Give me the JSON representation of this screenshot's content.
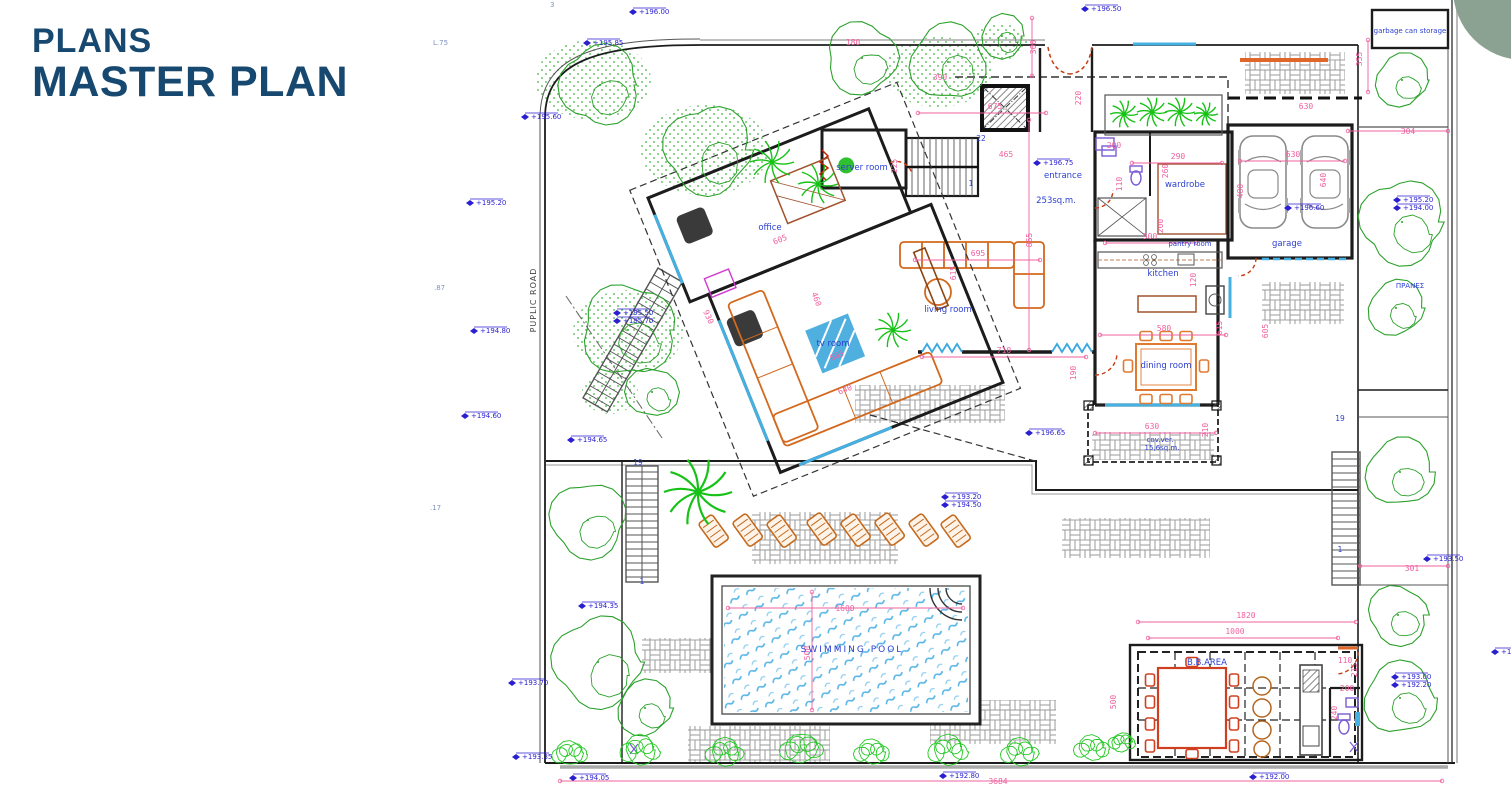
{
  "header": {
    "line1": "PLANS",
    "line2": "MASTER PLAN"
  },
  "colors": {
    "title": "#17486f",
    "accent_circle": "#8ba292",
    "dimension": "#f0609f",
    "elevation": "#2a1fd0",
    "room_label": "#2b3fd0",
    "tree": "#2ca12c",
    "palm": "#16c216",
    "furniture": "#d2691e",
    "pool_water": "#58b5e6",
    "wall": "#1c1c1c"
  },
  "plan": {
    "road_label": {
      "t": "PUPLIC ROAD",
      "x": 536,
      "y": 300
    },
    "labels": [
      {
        "t": "server room",
        "x": 862,
        "y": 170,
        "cls": "room"
      },
      {
        "t": "entrance",
        "x": 1063,
        "y": 178,
        "cls": "room"
      },
      {
        "t": "253sq.m.",
        "x": 1056,
        "y": 203,
        "cls": "room"
      },
      {
        "t": "wardrobe",
        "x": 1185,
        "y": 187,
        "cls": "room"
      },
      {
        "t": "office",
        "x": 770,
        "y": 230,
        "cls": "room"
      },
      {
        "t": "tv room",
        "x": 833,
        "y": 346,
        "cls": "room"
      },
      {
        "t": "living room",
        "x": 948,
        "y": 312,
        "cls": "room"
      },
      {
        "t": "kitchen",
        "x": 1163,
        "y": 276,
        "cls": "room"
      },
      {
        "t": "pantry room",
        "x": 1190,
        "y": 246,
        "cls": "small"
      },
      {
        "t": "dining room",
        "x": 1166,
        "y": 368,
        "cls": "room"
      },
      {
        "t": "garage",
        "x": 1287,
        "y": 246,
        "cls": "room"
      },
      {
        "t": "garbage can storage",
        "x": 1410,
        "y": 33,
        "cls": "small"
      },
      {
        "t": "ΠΡΑΝΕΣ",
        "x": 1410,
        "y": 288,
        "cls": "small"
      },
      {
        "t": "SWIMMING POOL",
        "x": 852,
        "y": 652,
        "cls": "pool"
      },
      {
        "t": "B.B.AREA",
        "x": 1207,
        "y": 665,
        "cls": "room"
      },
      {
        "t": "cov.ver.",
        "x": 1160,
        "y": 442,
        "cls": "small"
      },
      {
        "t": "15,6sq.m.",
        "x": 1162,
        "y": 450,
        "cls": "small"
      },
      {
        "t": "22",
        "x": 981,
        "y": 141,
        "cls": "num"
      },
      {
        "t": "1",
        "x": 971,
        "y": 186,
        "cls": "num"
      },
      {
        "t": "19",
        "x": 638,
        "y": 465,
        "cls": "num"
      },
      {
        "t": "1",
        "x": 642,
        "y": 584,
        "cls": "num"
      },
      {
        "t": "19",
        "x": 1340,
        "y": 421,
        "cls": "num"
      },
      {
        "t": "1",
        "x": 1340,
        "y": 552,
        "cls": "num"
      },
      {
        "t": "L.75",
        "x": 433,
        "y": 45,
        "cls": "note"
      },
      {
        "t": ".87",
        "x": 434,
        "y": 290,
        "cls": "note"
      },
      {
        "t": ".17",
        "x": 430,
        "y": 510,
        "cls": "note"
      },
      {
        "t": "3",
        "x": 550,
        "y": 7,
        "cls": "note"
      }
    ],
    "dimensions": [
      {
        "t": "675",
        "x": 995,
        "y": 109
      },
      {
        "t": "180",
        "x": 853,
        "y": 45
      },
      {
        "t": "390",
        "x": 940,
        "y": 80
      },
      {
        "t": "225",
        "x": 897,
        "y": 166,
        "rot": -90
      },
      {
        "t": "465",
        "x": 1006,
        "y": 157
      },
      {
        "t": "300",
        "x": 1036,
        "y": 47,
        "rot": -90
      },
      {
        "t": "220",
        "x": 1081,
        "y": 98,
        "rot": -90
      },
      {
        "t": "865",
        "x": 1032,
        "y": 240,
        "rot": -90
      },
      {
        "t": "695",
        "x": 978,
        "y": 256
      },
      {
        "t": "615",
        "x": 956,
        "y": 273,
        "rot": -90
      },
      {
        "t": "605",
        "x": 781,
        "y": 242,
        "rot": -22
      },
      {
        "t": "930",
        "x": 706,
        "y": 318,
        "rot": 66
      },
      {
        "t": "605",
        "x": 838,
        "y": 358,
        "rot": -22
      },
      {
        "t": "640",
        "x": 846,
        "y": 392,
        "rot": -22
      },
      {
        "t": "460",
        "x": 814,
        "y": 300,
        "rot": 70
      },
      {
        "t": "710",
        "x": 1004,
        "y": 353
      },
      {
        "t": "190",
        "x": 1076,
        "y": 373,
        "rot": -90
      },
      {
        "t": "290",
        "x": 1178,
        "y": 159
      },
      {
        "t": "110",
        "x": 1122,
        "y": 184,
        "rot": -90
      },
      {
        "t": "260",
        "x": 1168,
        "y": 171,
        "rot": -90
      },
      {
        "t": "200",
        "x": 1163,
        "y": 226,
        "rot": -90
      },
      {
        "t": "200",
        "x": 1114,
        "y": 148
      },
      {
        "t": "500",
        "x": 1150,
        "y": 239
      },
      {
        "t": "580",
        "x": 1164,
        "y": 331
      },
      {
        "t": "120",
        "x": 1196,
        "y": 280,
        "rot": -90
      },
      {
        "t": "615",
        "x": 1222,
        "y": 328,
        "rot": -90
      },
      {
        "t": "605",
        "x": 1268,
        "y": 331,
        "rot": -90
      },
      {
        "t": "480",
        "x": 1243,
        "y": 191,
        "rot": -90
      },
      {
        "t": "630",
        "x": 1293,
        "y": 157
      },
      {
        "t": "640",
        "x": 1326,
        "y": 180,
        "rot": -90
      },
      {
        "t": "355",
        "x": 1362,
        "y": 59,
        "rot": -90
      },
      {
        "t": "630",
        "x": 1306,
        "y": 109
      },
      {
        "t": "304",
        "x": 1408,
        "y": 134
      },
      {
        "t": "301",
        "x": 1412,
        "y": 571
      },
      {
        "t": "1600",
        "x": 845,
        "y": 611
      },
      {
        "t": "500",
        "x": 810,
        "y": 653,
        "rot": -90
      },
      {
        "t": "1820",
        "x": 1246,
        "y": 618
      },
      {
        "t": "1000",
        "x": 1235,
        "y": 634
      },
      {
        "t": "110",
        "x": 1345,
        "y": 663
      },
      {
        "t": "215",
        "x": 1357,
        "y": 670,
        "rot": -90
      },
      {
        "t": "200",
        "x": 1347,
        "y": 691
      },
      {
        "t": "240",
        "x": 1337,
        "y": 713,
        "rot": -90
      },
      {
        "t": "500",
        "x": 1116,
        "y": 702,
        "rot": -90
      },
      {
        "t": "3684",
        "x": 998,
        "y": 784
      },
      {
        "t": "630",
        "x": 1152,
        "y": 429
      },
      {
        "t": "210",
        "x": 1208,
        "y": 430,
        "rot": -90
      }
    ],
    "elevations": [
      {
        "t": "+196.00",
        "x": 640,
        "y": 12
      },
      {
        "t": "+195.85",
        "x": 594,
        "y": 43
      },
      {
        "t": "+195.60",
        "x": 532,
        "y": 117
      },
      {
        "t": "+196.50",
        "x": 1092,
        "y": 9
      },
      {
        "t": "+195.20",
        "x": 477,
        "y": 203
      },
      {
        "t": "+194.80",
        "x": 481,
        "y": 331
      },
      {
        "t": "+194.60",
        "x": 472,
        "y": 416
      },
      {
        "t": "+194.65",
        "x": 578,
        "y": 440
      },
      {
        "t": "+194.35",
        "x": 589,
        "y": 606
      },
      {
        "t": "+193.70",
        "x": 519,
        "y": 683
      },
      {
        "t": "+193.35",
        "x": 523,
        "y": 757
      },
      {
        "t": "+194.05",
        "x": 580,
        "y": 778
      },
      {
        "t": "+192.80",
        "x": 950,
        "y": 776
      },
      {
        "t": "+192.00",
        "x": 1260,
        "y": 777
      },
      {
        "t": "+196.75",
        "x": 1044,
        "y": 163
      },
      {
        "t": "+196.65",
        "x": 1036,
        "y": 433
      },
      {
        "t": "+193.20",
        "x": 952,
        "y": 497
      },
      {
        "t": "+194.50",
        "x": 952,
        "y": 505
      },
      {
        "t": "+195.50",
        "x": 624,
        "y": 313
      },
      {
        "t": "+195.70",
        "x": 624,
        "y": 321
      },
      {
        "t": "+195.20",
        "x": 1404,
        "y": 200
      },
      {
        "t": "+194.00",
        "x": 1404,
        "y": 208
      },
      {
        "t": "+196.60",
        "x": 1295,
        "y": 208
      },
      {
        "t": "+193.50",
        "x": 1434,
        "y": 559
      },
      {
        "t": "+193.00",
        "x": 1402,
        "y": 677
      },
      {
        "t": "+192.20",
        "x": 1402,
        "y": 685
      },
      {
        "t": "+19",
        "x": 1502,
        "y": 652
      }
    ],
    "dim_lines": [
      [
        728,
        608,
        963,
        608
      ],
      [
        812,
        592,
        812,
        710
      ],
      [
        1138,
        622,
        1356,
        622
      ],
      [
        1148,
        638,
        1338,
        638
      ],
      [
        918,
        113,
        1046,
        113
      ],
      [
        922,
        357,
        1086,
        357
      ],
      [
        1132,
        163,
        1222,
        163
      ],
      [
        1240,
        161,
        1345,
        161
      ],
      [
        1100,
        335,
        1226,
        335
      ],
      [
        1105,
        243,
        1196,
        243
      ],
      [
        915,
        260,
        1040,
        260
      ],
      [
        1095,
        433,
        1216,
        433
      ],
      [
        1348,
        131,
        1448,
        131
      ],
      [
        1360,
        566,
        1448,
        566
      ],
      [
        1032,
        18,
        1032,
        76
      ],
      [
        1368,
        40,
        1368,
        92
      ],
      [
        560,
        781,
        1442,
        781
      ],
      [
        1029,
        120,
        1029,
        350
      ]
    ],
    "trees": [
      {
        "x": 600,
        "y": 85,
        "r": 40
      },
      {
        "x": 708,
        "y": 150,
        "r": 44
      },
      {
        "x": 862,
        "y": 58,
        "r": 36
      },
      {
        "x": 948,
        "y": 62,
        "r": 38
      },
      {
        "x": 1002,
        "y": 36,
        "r": 22
      },
      {
        "x": 628,
        "y": 330,
        "r": 46
      },
      {
        "x": 652,
        "y": 392,
        "r": 26
      },
      {
        "x": 588,
        "y": 520,
        "r": 38
      },
      {
        "x": 598,
        "y": 662,
        "r": 45
      },
      {
        "x": 645,
        "y": 708,
        "r": 28
      },
      {
        "x": 1402,
        "y": 80,
        "r": 27
      },
      {
        "x": 1402,
        "y": 222,
        "r": 42
      },
      {
        "x": 1396,
        "y": 308,
        "r": 28
      },
      {
        "x": 1400,
        "y": 472,
        "r": 34
      },
      {
        "x": 1398,
        "y": 615,
        "r": 30
      },
      {
        "x": 1400,
        "y": 698,
        "r": 36
      }
    ],
    "palms": [
      {
        "x": 698,
        "y": 492,
        "r": 34
      },
      {
        "x": 772,
        "y": 162,
        "r": 22
      },
      {
        "x": 818,
        "y": 184,
        "r": 20
      },
      {
        "x": 893,
        "y": 330,
        "r": 18
      },
      {
        "x": 1124,
        "y": 114,
        "r": 14
      },
      {
        "x": 1152,
        "y": 112,
        "r": 15
      },
      {
        "x": 1180,
        "y": 112,
        "r": 15
      },
      {
        "x": 1206,
        "y": 114,
        "r": 12
      }
    ],
    "hedges": [
      {
        "x": 593,
        "y": 80,
        "rx": 58,
        "ry": 40
      },
      {
        "x": 705,
        "y": 150,
        "rx": 64,
        "ry": 45
      },
      {
        "x": 938,
        "y": 72,
        "rx": 55,
        "ry": 35
      },
      {
        "x": 628,
        "y": 332,
        "rx": 55,
        "ry": 42
      },
      {
        "x": 610,
        "y": 392,
        "rx": 28,
        "ry": 22
      },
      {
        "x": 1000,
        "y": 42,
        "rx": 28,
        "ry": 18
      }
    ],
    "shrubs": [
      {
        "x": 570,
        "y": 753,
        "r": 13
      },
      {
        "x": 640,
        "y": 750,
        "r": 15
      },
      {
        "x": 725,
        "y": 752,
        "r": 14
      },
      {
        "x": 802,
        "y": 748,
        "r": 16
      },
      {
        "x": 872,
        "y": 752,
        "r": 13
      },
      {
        "x": 948,
        "y": 750,
        "r": 15
      },
      {
        "x": 1020,
        "y": 752,
        "r": 14
      },
      {
        "x": 1092,
        "y": 748,
        "r": 13
      },
      {
        "x": 1122,
        "y": 742,
        "r": 10
      }
    ]
  }
}
